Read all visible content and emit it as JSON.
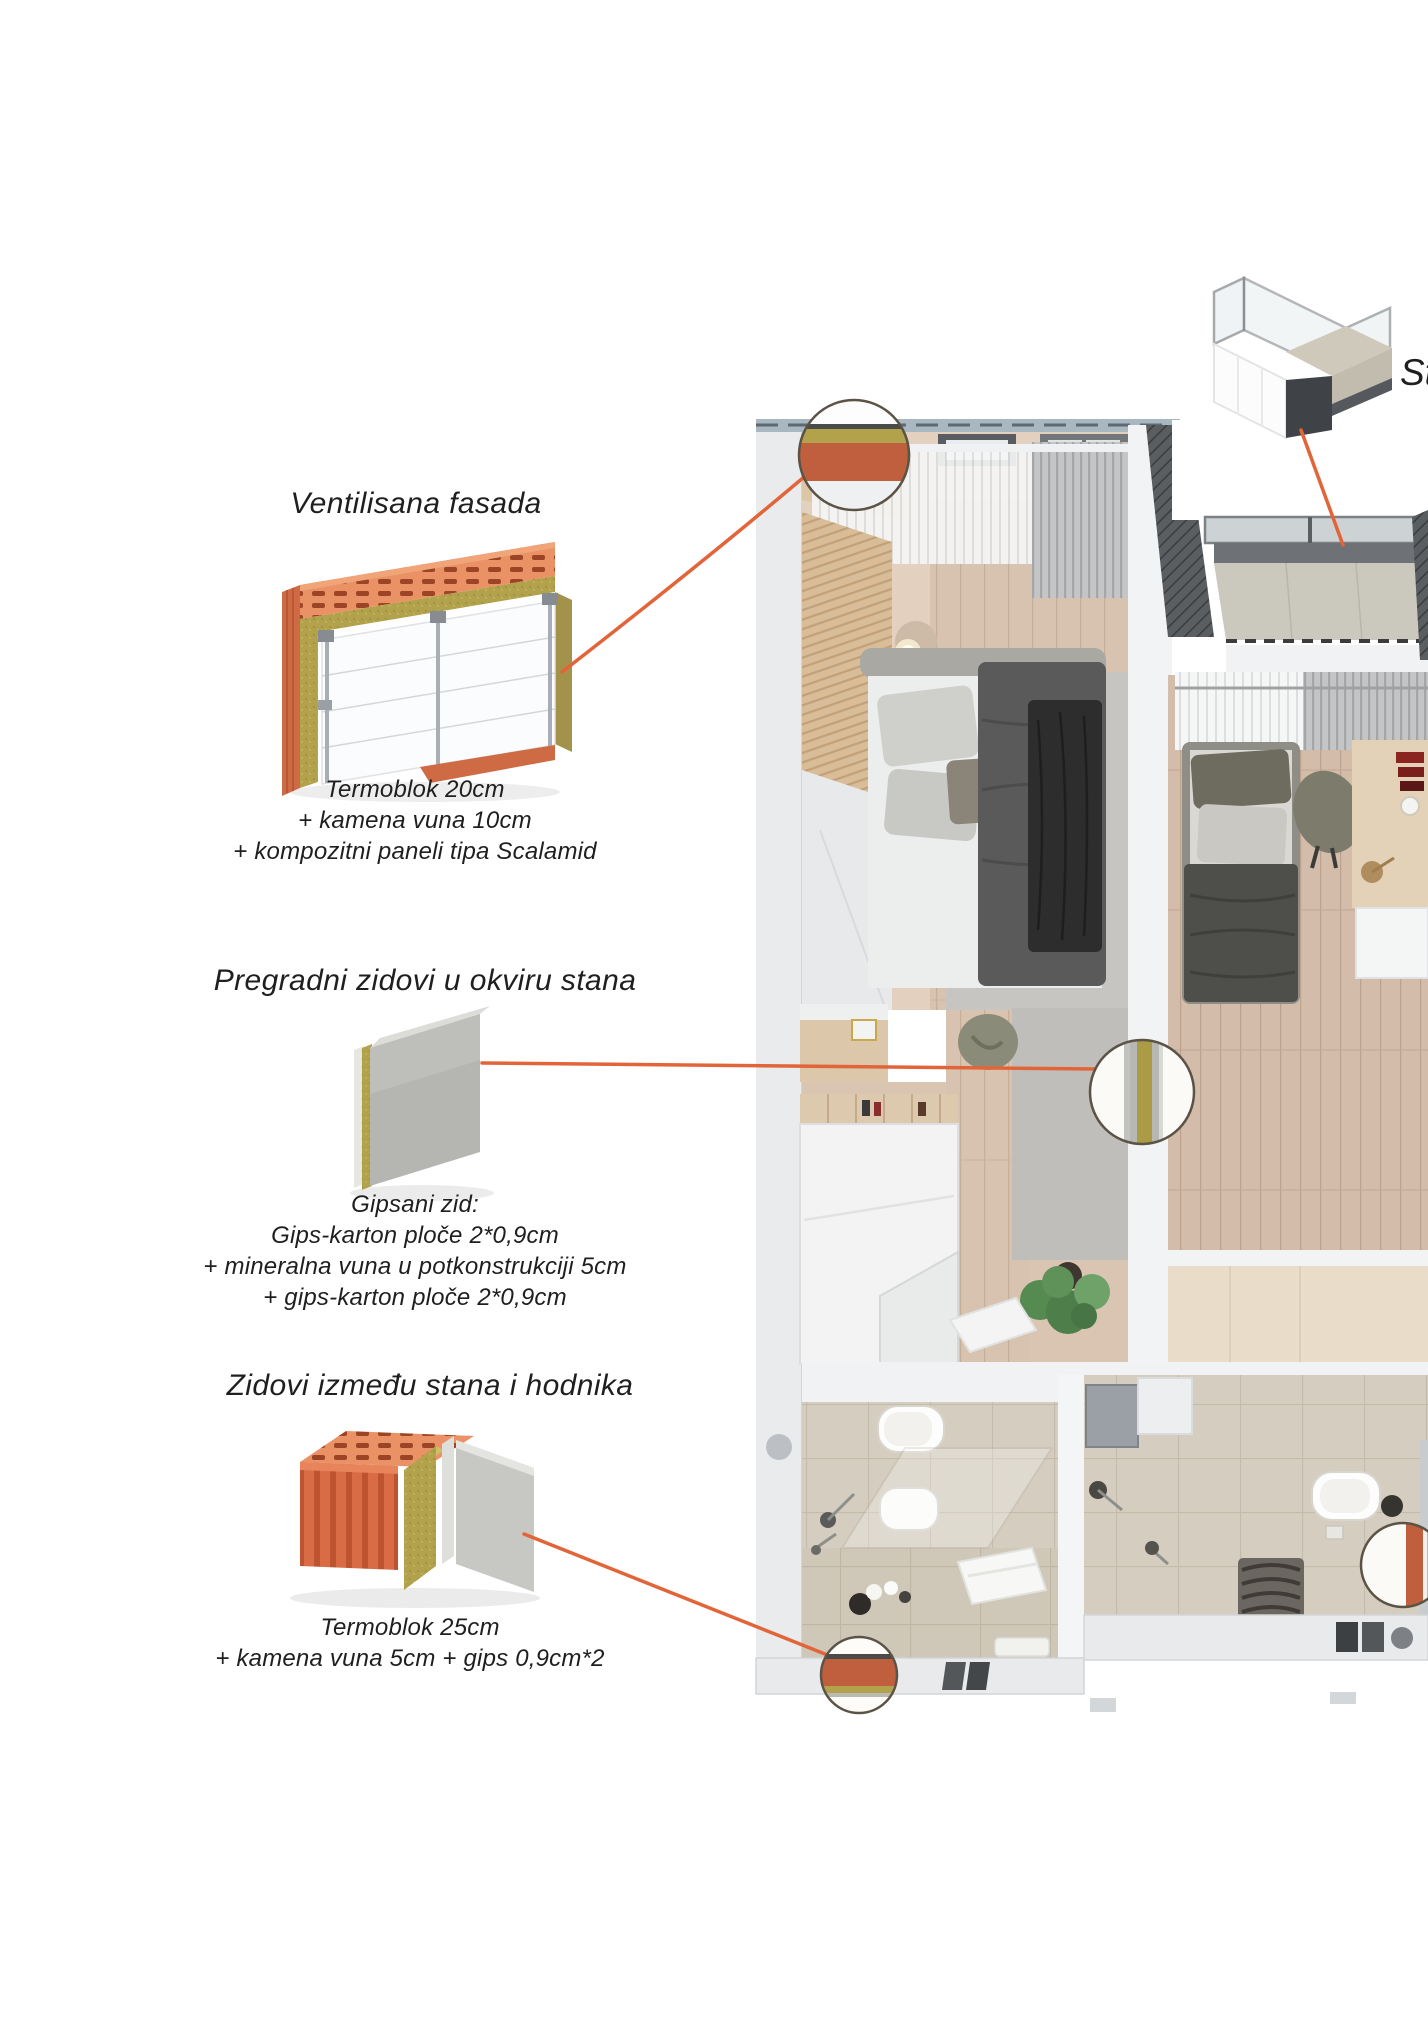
{
  "annotations": {
    "sections": [
      {
        "id": "ventilisana-fasada",
        "title": "Ventilisana fasada",
        "lines": [
          "Termoblok 20cm",
          "+ kamena vuna 10cm",
          "+ kompozitni paneli tipa Scalamid"
        ]
      },
      {
        "id": "pregradni-zidovi",
        "title": "Pregradni zidovi u okviru stana",
        "lines": [
          "Gipsani zid:",
          "Gips-karton ploče 2*0,9cm",
          "+ mineralna vuna u potkonstrukciji 5cm",
          "+ gips-karton ploče 2*0,9cm"
        ]
      },
      {
        "id": "zidovi-izmedju-stana-i-hodnika",
        "title": "Zidovi između stana i hodnika",
        "lines": [
          "Termoblok 25cm",
          "+ kamena vuna 5cm + gips 0,9cm*2"
        ]
      }
    ],
    "balcony_label_partial": "St"
  },
  "callouts": [
    {
      "name": "facade-wall-section",
      "layers": [
        "composite panel",
        "membrane",
        "mineral wool",
        "termoblok"
      ]
    },
    {
      "name": "partition-wall-section",
      "layers": [
        "gypsum board",
        "mineral wool",
        "gypsum board"
      ]
    },
    {
      "name": "hallway-wall-section-bottom",
      "layers": [
        "gypsum",
        "termoblok",
        "mineral wool"
      ]
    },
    {
      "name": "hallway-wall-section-right",
      "layers": [
        "termoblok",
        "gypsum"
      ]
    }
  ],
  "colors": {
    "leader_line": "#e2653a",
    "termoblok": "#bf5f3e",
    "brick": "#d96c44",
    "mineral_wool": "#b3a24c",
    "gypsum_gray": "#b9b9b5",
    "plan_outer_wall": "#e9ebed",
    "wood_floor": "#d8c3b1",
    "bath_tile": "#d5cec0",
    "text": "#1f1f1f"
  }
}
